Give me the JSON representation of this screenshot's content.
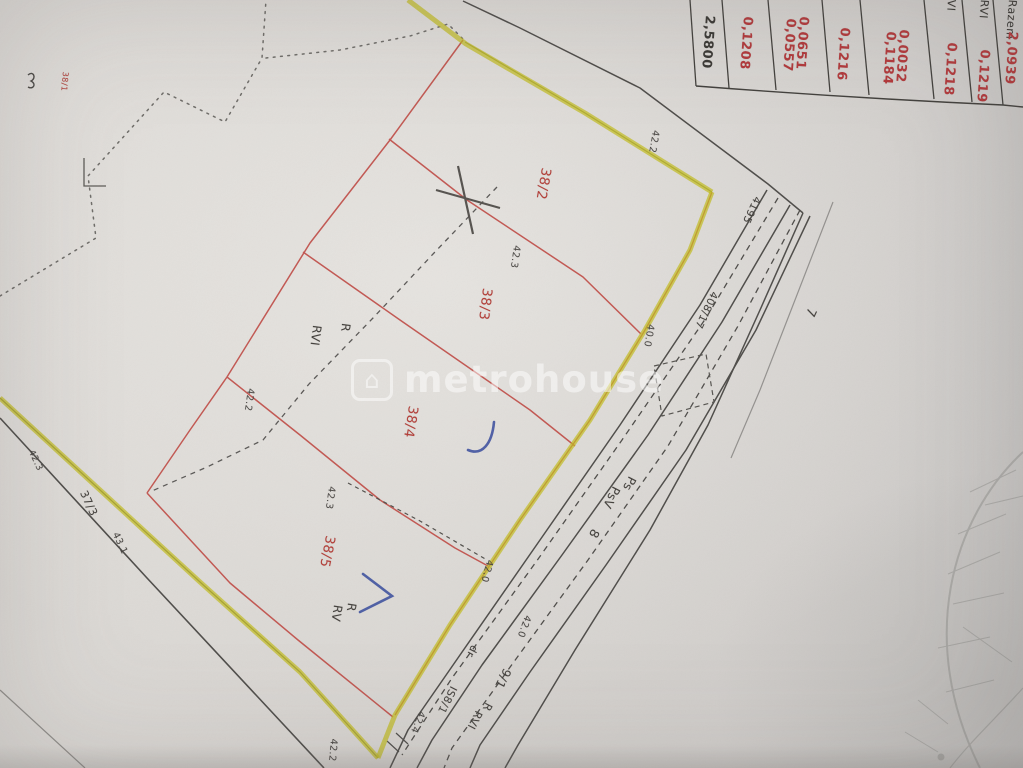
{
  "watermark": {
    "text": "metrohouse",
    "logo_glyph": "⌂"
  },
  "area_table": {
    "columns": [
      {
        "values": [
          "2,5800"
        ],
        "value_color": "black"
      },
      {
        "values": [
          "0,1208"
        ],
        "value_color": "red"
      },
      {
        "values": [
          "0,0651",
          "0,0557"
        ],
        "value_color": "red"
      },
      {
        "values": [
          "0,1216"
        ],
        "value_color": "red"
      },
      {
        "values": [
          "0,0032",
          "0,1184"
        ],
        "value_color": "red"
      },
      {
        "header": "VI",
        "values": [
          "0,1218"
        ],
        "value_color": "red"
      },
      {
        "header": "RVI",
        "values": [
          "0,1219"
        ],
        "value_color": "red"
      },
      {
        "header": "Razem",
        "values": [
          "2,0939"
        ],
        "value_color": "red"
      }
    ]
  },
  "map_labels": [
    {
      "id": "plot-number-38-1",
      "text": "38/1",
      "class": "red",
      "x": 69,
      "y": 72,
      "size": 8,
      "rotation": 95
    },
    {
      "id": "plot-number-38-2",
      "text": "38/2",
      "class": "red",
      "x": 553,
      "y": 169,
      "size": 13.5,
      "rotation": 100
    },
    {
      "id": "plot-number-38-3",
      "text": "38/3",
      "class": "red",
      "x": 494,
      "y": 289,
      "size": 13.5,
      "rotation": 97
    },
    {
      "id": "plot-number-38-4",
      "text": "38/4",
      "class": "red",
      "x": 420,
      "y": 407,
      "size": 13.5,
      "rotation": 99
    },
    {
      "id": "plot-number-38-5",
      "text": "38/5",
      "class": "red",
      "x": 337,
      "y": 537,
      "size": 13.5,
      "rotation": 101
    },
    {
      "id": "landuse-r-38-3",
      "text": "R",
      "class": "blk",
      "x": 352,
      "y": 324,
      "size": 12,
      "rotation": 97
    },
    {
      "id": "landuse-rvi-38-3",
      "text": "RVI",
      "class": "blk",
      "x": 323,
      "y": 326,
      "size": 12,
      "rotation": 97
    },
    {
      "id": "landuse-r-38-5",
      "text": "R",
      "class": "blk",
      "x": 358,
      "y": 604,
      "size": 12,
      "rotation": 99
    },
    {
      "id": "landuse-rv-38-5",
      "text": "RV",
      "class": "blk",
      "x": 344,
      "y": 606,
      "size": 12,
      "rotation": 99
    },
    {
      "id": "road-ps",
      "text": "Ps",
      "class": "blk",
      "x": 638,
      "y": 480,
      "size": 12,
      "rotation": 117
    },
    {
      "id": "road-psv",
      "text": "PsV",
      "class": "blk",
      "x": 622,
      "y": 490,
      "size": 12,
      "rotation": 117
    },
    {
      "id": "road-8",
      "text": "8",
      "class": "blk",
      "x": 602,
      "y": 533,
      "size": 12.5,
      "rotation": 117
    },
    {
      "id": "road-9-1",
      "text": "9/1",
      "class": "blk",
      "x": 513,
      "y": 672,
      "size": 12,
      "rotation": 117
    },
    {
      "id": "landuse-r-9-1",
      "text": "R",
      "class": "blk",
      "x": 494,
      "y": 706,
      "size": 11,
      "rotation": 117
    },
    {
      "id": "landuse-rvi-9-1",
      "text": "RVI",
      "class": "blk",
      "x": 484,
      "y": 714,
      "size": 11,
      "rotation": 117
    },
    {
      "id": "road-is8-1",
      "text": "IS8/1",
      "class": "blk",
      "x": 458,
      "y": 689,
      "size": 10.5,
      "rotation": 117
    },
    {
      "id": "road-dr",
      "text": "dr",
      "class": "blk",
      "x": 479,
      "y": 648,
      "size": 10.5,
      "rotation": 117
    },
    {
      "id": "road-7",
      "text": "7",
      "class": "blk",
      "x": 818,
      "y": 311,
      "size": 13,
      "rotation": 115
    },
    {
      "id": "point-4195",
      "text": "4195",
      "class": "blk",
      "x": 762,
      "y": 199,
      "size": 10.5,
      "rotation": 115
    },
    {
      "id": "road-408-17",
      "text": "408/17",
      "class": "blk",
      "x": 719,
      "y": 294,
      "size": 10.5,
      "rotation": 115
    },
    {
      "id": "road-37-3",
      "text": "37/3",
      "class": "blk",
      "x": 88,
      "y": 489,
      "size": 11,
      "rotation": 65
    },
    {
      "id": "meas-43-1",
      "text": "43.1",
      "class": "meas",
      "x": 119,
      "y": 531,
      "size": 9.5,
      "rotation": 65
    },
    {
      "id": "meas-42-3-west",
      "text": "42.3",
      "class": "meas",
      "x": 34,
      "y": 449,
      "size": 9,
      "rotation": 65
    },
    {
      "id": "meas-42-2-top",
      "text": "42.2",
      "class": "meas",
      "x": 660,
      "y": 131,
      "size": 9.5,
      "rotation": 100
    },
    {
      "id": "meas-42-3-a",
      "text": "42.3",
      "class": "meas",
      "x": 521,
      "y": 246,
      "size": 9.5,
      "rotation": 98
    },
    {
      "id": "meas-40-0",
      "text": "40.0",
      "class": "meas",
      "x": 655,
      "y": 325,
      "size": 9.5,
      "rotation": 100
    },
    {
      "id": "meas-42-2-b",
      "text": "42.2",
      "class": "meas",
      "x": 255,
      "y": 389,
      "size": 9.5,
      "rotation": 98
    },
    {
      "id": "meas-42-3-b",
      "text": "42.3",
      "class": "meas",
      "x": 336,
      "y": 487,
      "size": 9.5,
      "rotation": 98
    },
    {
      "id": "meas-42-0-a",
      "text": "42.0",
      "class": "meas",
      "x": 494,
      "y": 561,
      "size": 9.5,
      "rotation": 105
    },
    {
      "id": "meas-42-0-b",
      "text": "42.0",
      "class": "meas",
      "x": 532,
      "y": 617,
      "size": 9.5,
      "rotation": 110
    },
    {
      "id": "meas-42-4",
      "text": "42.4",
      "class": "meas",
      "x": 426,
      "y": 713,
      "size": 9.5,
      "rotation": 112
    },
    {
      "id": "meas-42-2-c",
      "text": "42.2",
      "class": "meas",
      "x": 338,
      "y": 739,
      "size": 9.5,
      "rotation": 95
    }
  ],
  "colors": {
    "paper": "#d9d6d2",
    "boundary_highlight_yellow": "#c1bb1c",
    "parcel_line_red": "#c0504a",
    "annotation_red": "#b4403a",
    "ink_black": "#45423e",
    "pen_blue": "#35499b"
  }
}
